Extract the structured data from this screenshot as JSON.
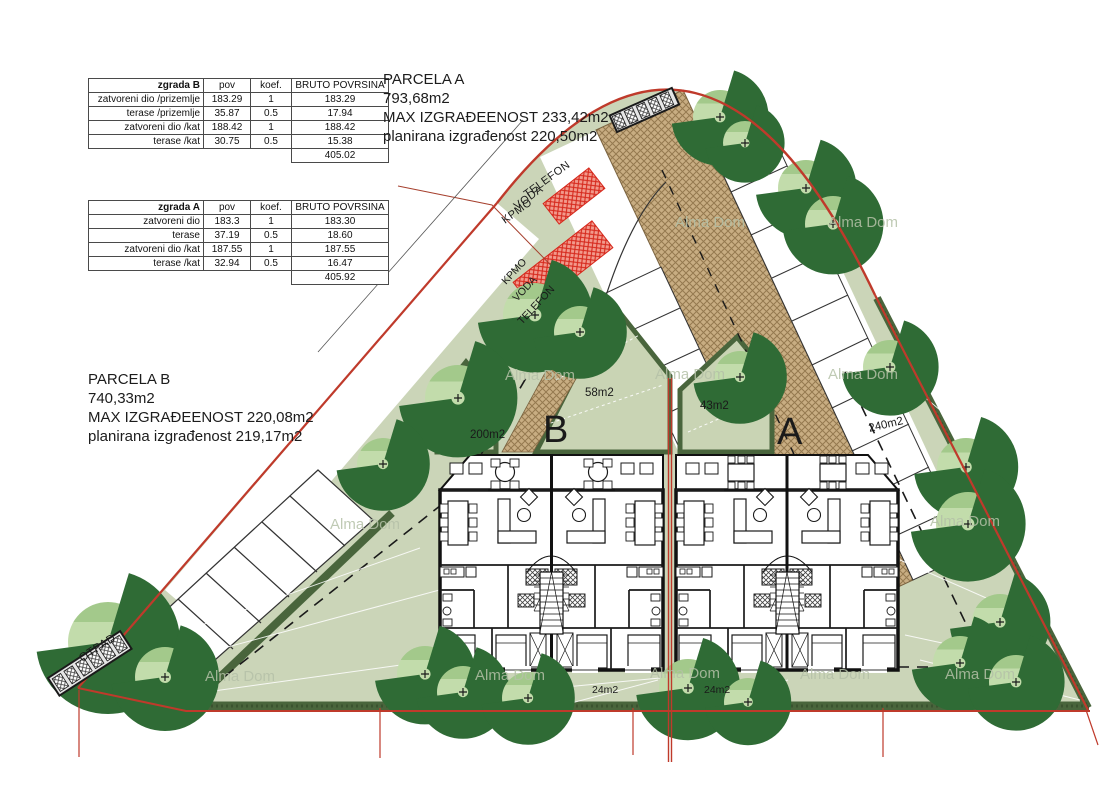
{
  "tables": {
    "zgrada_b": {
      "title": "zgrada B",
      "col_headers": [
        "pov",
        "koef.",
        "BRUTO POVRSINA"
      ],
      "rows": [
        {
          "label": "zatvoreni dio /prizemlje",
          "pov": "183.29",
          "koef": "1",
          "bruto": "183.29"
        },
        {
          "label": "terase /prizemlje",
          "pov": "35.87",
          "koef": "0.5",
          "bruto": "17.94"
        },
        {
          "label": "zatvoreni dio /kat",
          "pov": "188.42",
          "koef": "1",
          "bruto": "188.42"
        },
        {
          "label": "terase /kat",
          "pov": "30.75",
          "koef": "0.5",
          "bruto": "15.38"
        }
      ],
      "total": "405.02"
    },
    "zgrada_a": {
      "title": "zgrada A",
      "col_headers": [
        "pov",
        "koef.",
        "BRUTO POVRSINA"
      ],
      "rows": [
        {
          "label": "zatvoreni dio",
          "pov": "183.3",
          "koef": "1",
          "bruto": "183.30"
        },
        {
          "label": "terase",
          "pov": "37.19",
          "koef": "0.5",
          "bruto": "18.60"
        },
        {
          "label": "zatvoreni dio /kat",
          "pov": "187.55",
          "koef": "1",
          "bruto": "187.55"
        },
        {
          "label": "terase /kat",
          "pov": "32.94",
          "koef": "0.5",
          "bruto": "16.47"
        }
      ],
      "total": "405.92"
    }
  },
  "parcela_a": {
    "title": "PARCELA A",
    "area": "793,68m2",
    "max_line": "MAX IZGRAĐEENOST 233,42m2",
    "planned_line": "planirana izgrađenost 220,50m2"
  },
  "parcela_b": {
    "title": "PARCELA B",
    "area": "740,33m2",
    "max_line": "MAX IZGRAĐEENOST 220,08m2",
    "planned_line": "planirana izgrađenost 219,17m2"
  },
  "plan": {
    "building_b_label": "B",
    "building_a_label": "A",
    "garden_b_area": "58m2",
    "garden_a_area": "43m2",
    "left_garden_area": "200m2",
    "right_garden_area": "240m2",
    "back_garden_b_area": "24m2",
    "back_garden_a_area": "24m2",
    "utilities_outer": [
      "TELEFON",
      "VODA",
      "KPMO"
    ],
    "utilities_inner": [
      "KPMO",
      "VODA",
      "TELEFON"
    ],
    "waste_label": "OTPAD",
    "watermark": "Alma Dom",
    "colors": {
      "boundary": "#bf3a2b",
      "grass": "#cbd5b8",
      "hedge": "#49653c",
      "driveway": "#c8ad82",
      "red_zone": "#d6281c",
      "tree_fill": "#c2dcab",
      "tree_stroke": "#2f6b35"
    }
  }
}
